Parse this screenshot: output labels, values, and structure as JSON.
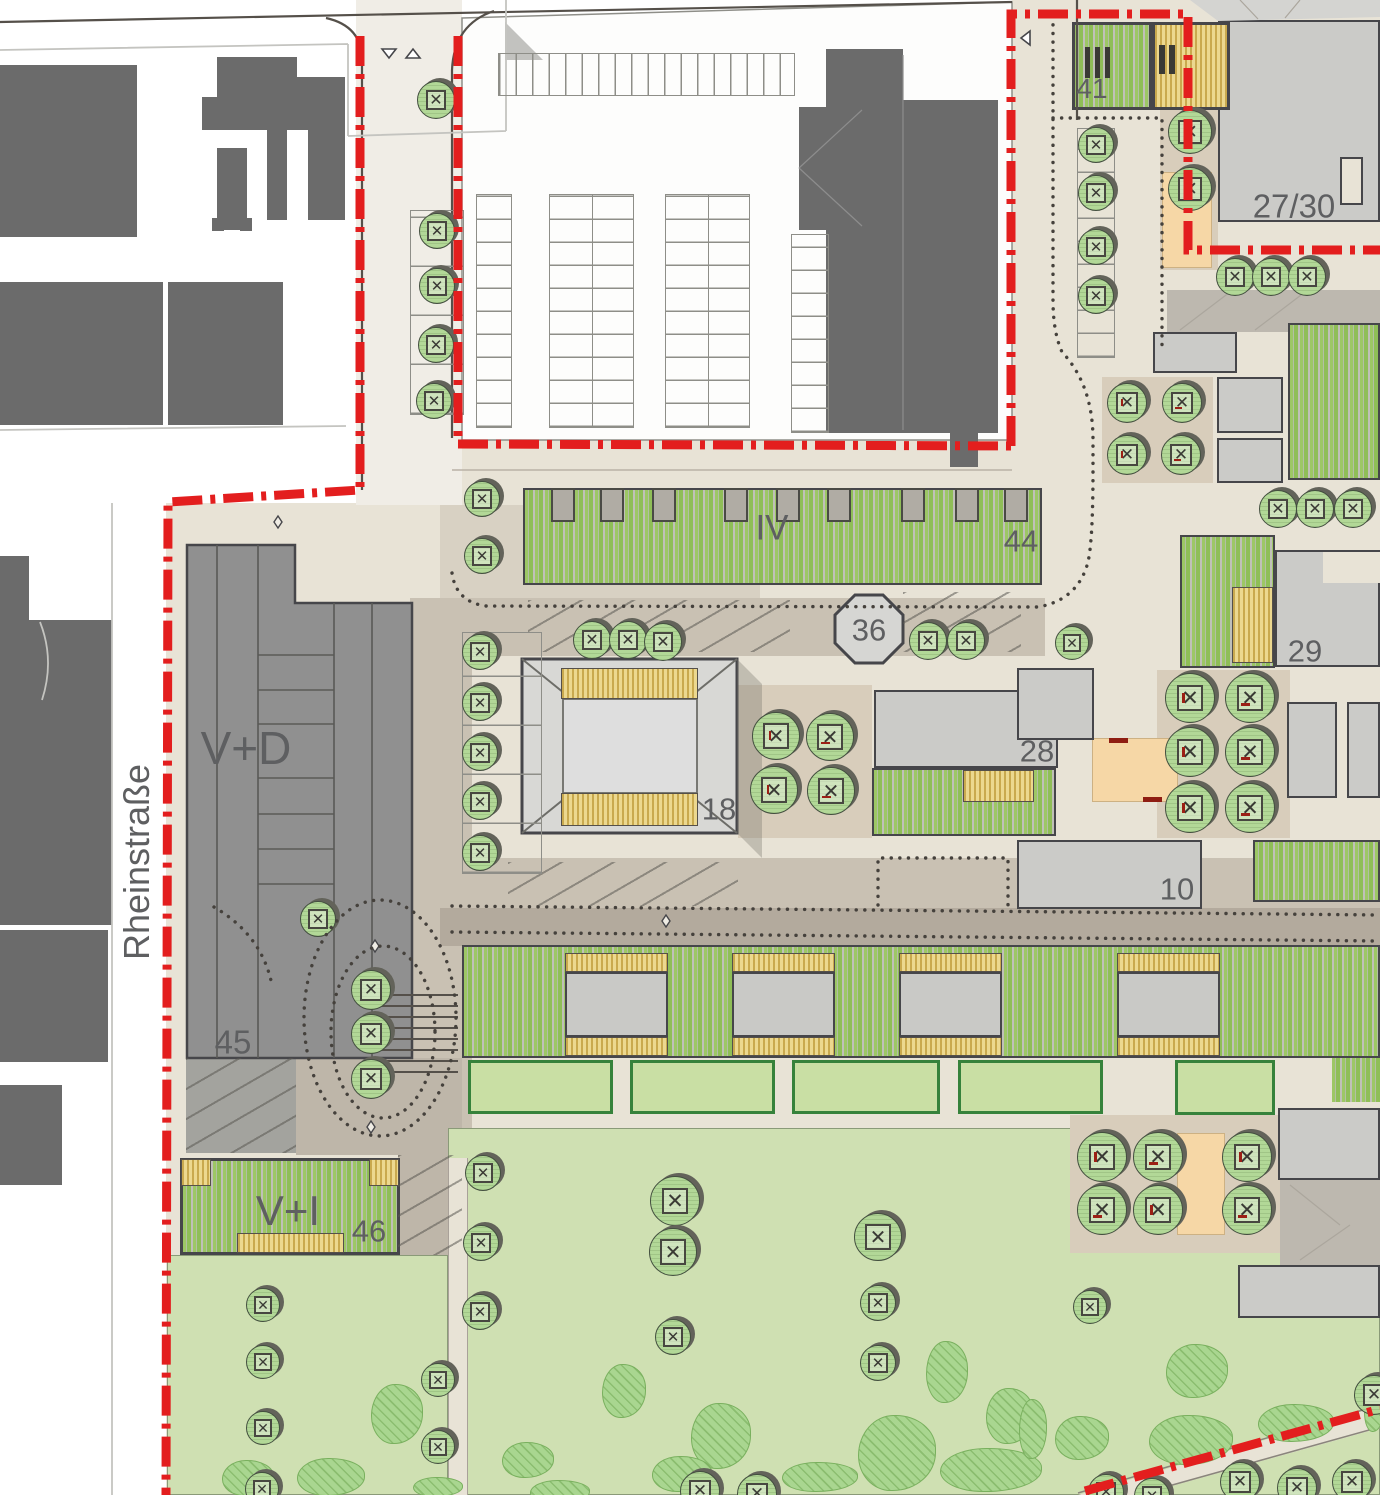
{
  "map": {
    "kind": "urban-site-plan",
    "street": {
      "name": "Rheinstraße"
    },
    "colors": {
      "boundary": "#e31e1e",
      "existing": "#6b6b6b",
      "planned": "#cbcbc8",
      "ground": "#e8e3d6",
      "road": "#c9c1b3",
      "walkway": "#b3aa9d",
      "tan": "#d8cdbb",
      "lawn": "#cfe0b2",
      "shrub": "#a9d690",
      "tree": "#b2d897",
      "deck": "#ecd88f",
      "deckstripe": "#c9a94e",
      "orange": "#f6d7a6",
      "bench": "#9c1f15"
    },
    "labels": [
      {
        "id": "rheinstrasse",
        "text": "Rheinstraße",
        "x": 137,
        "y": 862,
        "size": 36,
        "rot": -90
      },
      {
        "id": "v-d",
        "text": "V+D",
        "x": 246,
        "y": 748,
        "size": 46,
        "rot": 0
      },
      {
        "id": "n45",
        "text": "45",
        "x": 233,
        "y": 1042,
        "size": 33,
        "rot": 0
      },
      {
        "id": "v-i",
        "text": "V+I",
        "x": 288,
        "y": 1211,
        "size": 42,
        "rot": 0
      },
      {
        "id": "n46",
        "text": "46",
        "x": 369,
        "y": 1231,
        "size": 31,
        "rot": 0
      },
      {
        "id": "iv",
        "text": "IV",
        "x": 772,
        "y": 528,
        "size": 35,
        "rot": 0
      },
      {
        "id": "n44",
        "text": "44",
        "x": 1021,
        "y": 541,
        "size": 31,
        "rot": 0
      },
      {
        "id": "n36",
        "text": "36",
        "x": 869,
        "y": 630,
        "size": 31,
        "rot": 0
      },
      {
        "id": "n18",
        "text": "18",
        "x": 719,
        "y": 809,
        "size": 31,
        "rot": 0
      },
      {
        "id": "n28",
        "text": "28",
        "x": 1037,
        "y": 751,
        "size": 31,
        "rot": 0
      },
      {
        "id": "n29",
        "text": "29",
        "x": 1305,
        "y": 651,
        "size": 31,
        "rot": 0
      },
      {
        "id": "n10",
        "text": "10",
        "x": 1177,
        "y": 889,
        "size": 31,
        "rot": 0
      },
      {
        "id": "n41",
        "text": "41",
        "x": 1092,
        "y": 89,
        "size": 28,
        "rot": 0
      },
      {
        "id": "n27-30",
        "text": "27/30",
        "x": 1294,
        "y": 206,
        "size": 33,
        "rot": 0
      }
    ],
    "trees": [
      {
        "x": 436,
        "y": 100,
        "r": 19
      },
      {
        "x": 437,
        "y": 231,
        "r": 18
      },
      {
        "x": 437,
        "y": 286,
        "r": 18
      },
      {
        "x": 436,
        "y": 345,
        "r": 18
      },
      {
        "x": 434,
        "y": 401,
        "r": 18
      },
      {
        "x": 482,
        "y": 499,
        "r": 18
      },
      {
        "x": 482,
        "y": 556,
        "r": 18
      },
      {
        "x": 480,
        "y": 652,
        "r": 18
      },
      {
        "x": 480,
        "y": 703,
        "r": 18
      },
      {
        "x": 480,
        "y": 753,
        "r": 18
      },
      {
        "x": 480,
        "y": 802,
        "r": 18
      },
      {
        "x": 480,
        "y": 853,
        "r": 18
      },
      {
        "x": 318,
        "y": 919,
        "r": 18
      },
      {
        "x": 371,
        "y": 990,
        "r": 20
      },
      {
        "x": 371,
        "y": 1034,
        "r": 20
      },
      {
        "x": 371,
        "y": 1079,
        "r": 20
      },
      {
        "x": 592,
        "y": 640,
        "r": 19
      },
      {
        "x": 628,
        "y": 640,
        "r": 19
      },
      {
        "x": 663,
        "y": 642,
        "r": 19
      },
      {
        "x": 928,
        "y": 641,
        "r": 19
      },
      {
        "x": 966,
        "y": 641,
        "r": 19
      },
      {
        "x": 1072,
        "y": 643,
        "r": 17
      },
      {
        "x": 776,
        "y": 736,
        "r": 24,
        "b": 1
      },
      {
        "x": 830,
        "y": 737,
        "r": 24,
        "b": 1
      },
      {
        "x": 774,
        "y": 790,
        "r": 24,
        "b": 1
      },
      {
        "x": 831,
        "y": 791,
        "r": 24,
        "b": 1
      },
      {
        "x": 1190,
        "y": 698,
        "r": 25,
        "b": 1
      },
      {
        "x": 1250,
        "y": 698,
        "r": 25,
        "b": 1
      },
      {
        "x": 1190,
        "y": 752,
        "r": 25,
        "b": 1
      },
      {
        "x": 1250,
        "y": 752,
        "r": 25,
        "b": 1
      },
      {
        "x": 1190,
        "y": 808,
        "r": 25,
        "b": 1
      },
      {
        "x": 1250,
        "y": 808,
        "r": 25,
        "b": 1
      },
      {
        "x": 1127,
        "y": 403,
        "r": 20,
        "b": 1
      },
      {
        "x": 1182,
        "y": 403,
        "r": 20,
        "b": 1
      },
      {
        "x": 1127,
        "y": 455,
        "r": 20,
        "b": 1
      },
      {
        "x": 1181,
        "y": 455,
        "r": 20,
        "b": 1
      },
      {
        "x": 1278,
        "y": 509,
        "r": 19
      },
      {
        "x": 1315,
        "y": 509,
        "r": 19
      },
      {
        "x": 1353,
        "y": 509,
        "r": 19
      },
      {
        "x": 1235,
        "y": 277,
        "r": 19
      },
      {
        "x": 1271,
        "y": 277,
        "r": 19
      },
      {
        "x": 1307,
        "y": 277,
        "r": 19
      },
      {
        "x": 1190,
        "y": 132,
        "r": 22
      },
      {
        "x": 1190,
        "y": 189,
        "r": 22
      },
      {
        "x": 1096,
        "y": 145,
        "r": 18
      },
      {
        "x": 1096,
        "y": 193,
        "r": 18
      },
      {
        "x": 1096,
        "y": 247,
        "r": 18
      },
      {
        "x": 1096,
        "y": 296,
        "r": 18
      },
      {
        "x": 1102,
        "y": 1157,
        "r": 25,
        "b": 1
      },
      {
        "x": 1158,
        "y": 1157,
        "r": 25,
        "b": 1
      },
      {
        "x": 1247,
        "y": 1157,
        "r": 25,
        "b": 1
      },
      {
        "x": 1102,
        "y": 1210,
        "r": 25,
        "b": 1
      },
      {
        "x": 1158,
        "y": 1210,
        "r": 25,
        "b": 1
      },
      {
        "x": 1247,
        "y": 1210,
        "r": 25,
        "b": 1
      },
      {
        "x": 1090,
        "y": 1307,
        "r": 17
      },
      {
        "x": 675,
        "y": 1201,
        "r": 25
      },
      {
        "x": 673,
        "y": 1252,
        "r": 24
      },
      {
        "x": 673,
        "y": 1337,
        "r": 18
      },
      {
        "x": 878,
        "y": 1237,
        "r": 24
      },
      {
        "x": 878,
        "y": 1303,
        "r": 18
      },
      {
        "x": 878,
        "y": 1363,
        "r": 18
      },
      {
        "x": 483,
        "y": 1173,
        "r": 18
      },
      {
        "x": 481,
        "y": 1243,
        "r": 18
      },
      {
        "x": 480,
        "y": 1312,
        "r": 18
      },
      {
        "x": 438,
        "y": 1380,
        "r": 17
      },
      {
        "x": 438,
        "y": 1447,
        "r": 17
      },
      {
        "x": 263,
        "y": 1305,
        "r": 17
      },
      {
        "x": 263,
        "y": 1362,
        "r": 17
      },
      {
        "x": 263,
        "y": 1428,
        "r": 17
      },
      {
        "x": 262,
        "y": 1489,
        "r": 17
      },
      {
        "x": 700,
        "y": 1491,
        "r": 20
      },
      {
        "x": 757,
        "y": 1494,
        "r": 20
      },
      {
        "x": 1106,
        "y": 1492,
        "r": 18
      },
      {
        "x": 1152,
        "y": 1496,
        "r": 18
      },
      {
        "x": 1240,
        "y": 1482,
        "r": 20
      },
      {
        "x": 1297,
        "y": 1488,
        "r": 20
      },
      {
        "x": 1352,
        "y": 1482,
        "r": 20
      },
      {
        "x": 1374,
        "y": 1395,
        "r": 20
      }
    ],
    "shrubs": [
      {
        "x": 397,
        "y": 1414,
        "rx": 26,
        "ry": 30
      },
      {
        "x": 248,
        "y": 1478,
        "rx": 26,
        "ry": 18
      },
      {
        "x": 331,
        "y": 1477,
        "rx": 34,
        "ry": 19
      },
      {
        "x": 438,
        "y": 1487,
        "rx": 25,
        "ry": 10
      },
      {
        "x": 624,
        "y": 1391,
        "rx": 22,
        "ry": 27
      },
      {
        "x": 721,
        "y": 1436,
        "rx": 30,
        "ry": 33
      },
      {
        "x": 682,
        "y": 1474,
        "rx": 30,
        "ry": 18
      },
      {
        "x": 820,
        "y": 1477,
        "rx": 38,
        "ry": 15
      },
      {
        "x": 897,
        "y": 1453,
        "rx": 39,
        "ry": 38
      },
      {
        "x": 947,
        "y": 1372,
        "rx": 21,
        "ry": 31
      },
      {
        "x": 1010,
        "y": 1416,
        "rx": 24,
        "ry": 28
      },
      {
        "x": 991,
        "y": 1470,
        "rx": 51,
        "ry": 22
      },
      {
        "x": 1197,
        "y": 1371,
        "rx": 31,
        "ry": 27
      },
      {
        "x": 1082,
        "y": 1438,
        "rx": 27,
        "ry": 22
      },
      {
        "x": 1033,
        "y": 1429,
        "rx": 14,
        "ry": 30
      },
      {
        "x": 1191,
        "y": 1440,
        "rx": 42,
        "ry": 25
      },
      {
        "x": 1296,
        "y": 1423,
        "rx": 38,
        "ry": 19
      },
      {
        "x": 1374,
        "y": 1411,
        "rx": 10,
        "ry": 21
      },
      {
        "x": 528,
        "y": 1460,
        "rx": 26,
        "ry": 18
      },
      {
        "x": 560,
        "y": 1492,
        "rx": 30,
        "ry": 12
      }
    ]
  }
}
